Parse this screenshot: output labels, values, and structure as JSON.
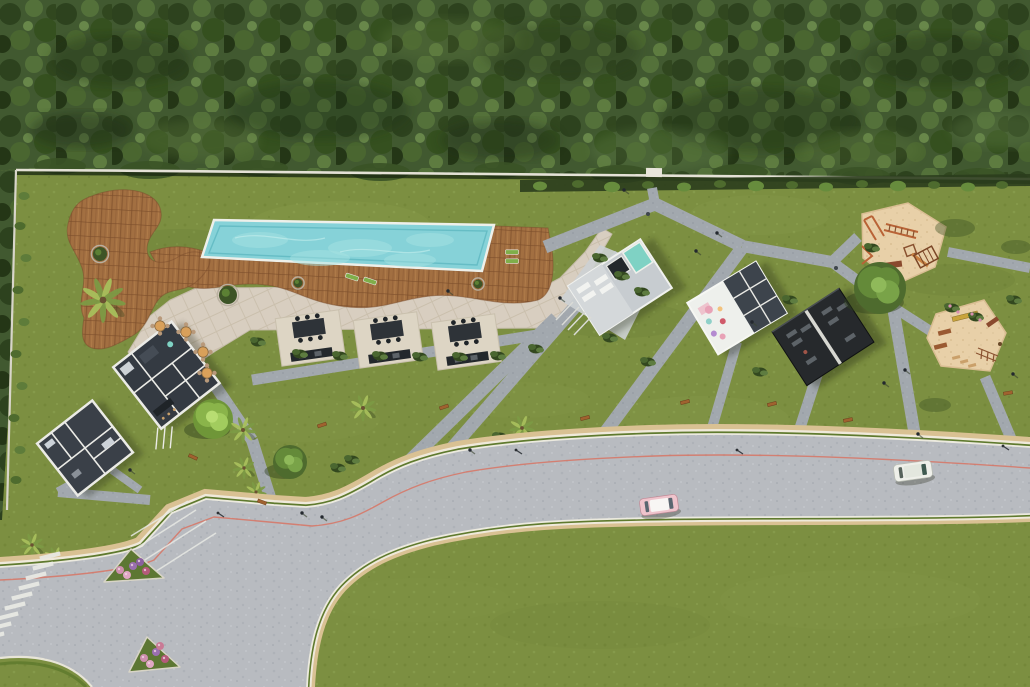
{
  "palette": {
    "lawn": "#7c8f41",
    "forest": "#415930",
    "wood": "#a26f41",
    "pool_water": "#86d2d8",
    "terrace": "#d8cec0",
    "path_gray": "#a2a8ae",
    "road": "#b8bbc0",
    "sand": "#e8d0a8",
    "hedge_dark": "#2b3d1d",
    "wall": "#e4e1d6",
    "red_line": "#d9705e",
    "curb_tan": "#d9c193",
    "verge_green": "#5f7a2e",
    "cream": "#efe9da",
    "flower_pink": "#cf8fae",
    "flower_purple": "#9a6fb0",
    "car_pink": "#efc4cc",
    "car_white": "#eff0ea",
    "equipment_orange": "#b96336",
    "building_floor": "#343a42",
    "building_wall": "#ebebe6",
    "black_pavilion": "#26292c",
    "teal_pool": "#7fd2c4",
    "lounger_green": "#7fae4a",
    "shadow": "#1a2410"
  },
  "scene": {
    "walk_paths": [
      [
        655,
        204,
        652,
        188,
        10
      ],
      [
        655,
        204,
        545,
        247,
        13
      ],
      [
        655,
        204,
        742,
        246,
        13
      ],
      [
        742,
        246,
        832,
        262,
        12
      ],
      [
        832,
        262,
        858,
        237,
        11
      ],
      [
        948,
        252,
        1030,
        268,
        10
      ],
      [
        832,
        262,
        893,
        307,
        11
      ],
      [
        893,
        307,
        932,
        332,
        10
      ],
      [
        893,
        307,
        915,
        436,
        12
      ],
      [
        985,
        377,
        1012,
        441,
        11
      ],
      [
        742,
        248,
        604,
        434,
        13
      ],
      [
        620,
        255,
        452,
        448,
        13
      ],
      [
        556,
        318,
        400,
        470,
        13
      ],
      [
        252,
        380,
        556,
        332,
        11
      ],
      [
        210,
        378,
        252,
        440,
        12
      ],
      [
        252,
        440,
        274,
        510,
        12
      ],
      [
        150,
        500,
        58,
        492,
        10
      ],
      [
        58,
        492,
        98,
        470,
        9
      ],
      [
        818,
        372,
        800,
        428,
        11
      ],
      [
        737,
        342,
        712,
        428,
        10
      ],
      [
        112,
        470,
        140,
        490,
        8
      ]
    ],
    "bbq_pads": [
      [
        310,
        336
      ],
      [
        388,
        338
      ],
      [
        466,
        340
      ]
    ],
    "benches": [
      [
        322,
        425,
        -18
      ],
      [
        444,
        407,
        -18
      ],
      [
        193,
        457,
        25
      ],
      [
        262,
        502,
        20
      ],
      [
        585,
        418,
        -14
      ],
      [
        685,
        402,
        -14
      ],
      [
        772,
        404,
        -14
      ],
      [
        848,
        420,
        -12
      ],
      [
        1008,
        393,
        -10
      ]
    ],
    "people": [
      [
        624,
        190
      ],
      [
        717,
        233
      ],
      [
        752,
        322
      ],
      [
        884,
        383
      ],
      [
        918,
        434
      ],
      [
        302,
        513
      ],
      [
        322,
        517
      ],
      [
        470,
        450
      ],
      [
        1013,
        374
      ],
      [
        696,
        251
      ],
      [
        905,
        370
      ],
      [
        130,
        470
      ],
      [
        448,
        291
      ],
      [
        560,
        298
      ]
    ],
    "street_lamps": [
      [
        218,
        513
      ],
      [
        516,
        450
      ],
      [
        737,
        450
      ],
      [
        1003,
        446
      ]
    ],
    "bins": [
      [
        648,
        214
      ],
      [
        836,
        268
      ]
    ],
    "palms": [
      [
        103,
        300,
        1.7
      ],
      [
        243,
        430,
        1.0
      ],
      [
        363,
        408,
        1.0
      ],
      [
        522,
        428,
        0.95
      ],
      [
        244,
        468,
        0.85
      ],
      [
        256,
        492,
        0.8
      ],
      [
        32,
        545,
        0.9
      ],
      [
        55,
        558,
        0.85
      ]
    ],
    "loungers": [
      [
        512,
        252,
        0
      ],
      [
        512,
        261,
        0
      ],
      [
        352,
        277,
        18
      ],
      [
        370,
        281,
        18
      ]
    ],
    "dining_tables": [
      [
        160,
        326
      ],
      [
        186,
        332
      ],
      [
        203,
        352
      ],
      [
        207,
        373
      ]
    ],
    "planters": [
      [
        298,
        283,
        4.5
      ],
      [
        478,
        284,
        4.5
      ],
      [
        228,
        295,
        9
      ],
      [
        100,
        254,
        7
      ]
    ],
    "trees": [
      [
        880,
        288,
        26,
        "std"
      ],
      [
        213,
        419,
        20,
        "light"
      ],
      [
        290,
        462,
        17,
        "std"
      ]
    ],
    "tree_shadows": [
      [
        955,
        228,
        20,
        9
      ],
      [
        1016,
        247,
        15,
        7
      ],
      [
        935,
        405,
        16,
        7
      ]
    ],
    "shrub_clusters": [
      [
        352,
        460
      ],
      [
        338,
        468
      ],
      [
        500,
        437
      ],
      [
        610,
        338
      ],
      [
        648,
        362
      ],
      [
        700,
        432
      ],
      [
        760,
        372
      ],
      [
        952,
        308
      ],
      [
        976,
        317
      ],
      [
        872,
        248
      ],
      [
        600,
        258
      ],
      [
        622,
        276
      ],
      [
        642,
        292
      ],
      [
        258,
        342
      ],
      [
        1014,
        300
      ],
      [
        536,
        349
      ],
      [
        790,
        300
      ],
      [
        300,
        354
      ],
      [
        340,
        356
      ],
      [
        380,
        356
      ],
      [
        420,
        357
      ],
      [
        460,
        357
      ],
      [
        498,
        356
      ]
    ],
    "flower_dots": [
      [
        950,
        306
      ],
      [
        958,
        312
      ],
      [
        972,
        314
      ],
      [
        980,
        320
      ]
    ],
    "wall_shrubs": [
      [
        540,
        186,
        7
      ],
      [
        578,
        184,
        6
      ],
      [
        612,
        187,
        8
      ],
      [
        648,
        185,
        6
      ],
      [
        684,
        187,
        7
      ],
      [
        720,
        184,
        6
      ],
      [
        756,
        186,
        8
      ],
      [
        792,
        185,
        6
      ],
      [
        826,
        187,
        7
      ],
      [
        862,
        184,
        6
      ],
      [
        898,
        186,
        8
      ],
      [
        934,
        185,
        6
      ],
      [
        968,
        187,
        7
      ],
      [
        1002,
        185,
        6
      ]
    ],
    "vines_left": [
      [
        24,
        196
      ],
      [
        20,
        226
      ],
      [
        26,
        258
      ],
      [
        18,
        290
      ],
      [
        24,
        322
      ],
      [
        16,
        354
      ],
      [
        22,
        386
      ],
      [
        14,
        418
      ],
      [
        20,
        450
      ],
      [
        16,
        480
      ]
    ],
    "forest_patches": [
      [
        120,
        60,
        70,
        26,
        "#243618",
        0.4
      ],
      [
        320,
        110,
        90,
        30,
        "#1f3014",
        0.35
      ],
      [
        560,
        50,
        80,
        28,
        "#2a3d1c",
        0.4
      ],
      [
        760,
        120,
        100,
        32,
        "#223417",
        0.38
      ],
      [
        940,
        60,
        80,
        26,
        "#243618",
        0.4
      ],
      [
        200,
        140,
        60,
        20,
        "#5e7a3c",
        0.3
      ],
      [
        450,
        40,
        70,
        22,
        "#5e7a3c",
        0.28
      ],
      [
        660,
        150,
        70,
        22,
        "#64824a",
        0.3
      ],
      [
        860,
        150,
        60,
        20,
        "#5e7a3c",
        0.28
      ],
      [
        1000,
        130,
        50,
        18,
        "#64824a",
        0.3
      ],
      [
        80,
        130,
        50,
        18,
        "#1c2b12",
        0.4
      ],
      [
        500,
        140,
        60,
        20,
        "#1c2b12",
        0.35
      ]
    ],
    "forest_fringe": [
      [
        60,
        166,
        26,
        8
      ],
      [
        150,
        170,
        30,
        9
      ],
      [
        260,
        168,
        28,
        8
      ],
      [
        380,
        172,
        30,
        9
      ],
      [
        500,
        170,
        26,
        8
      ],
      [
        620,
        174,
        30,
        9
      ],
      [
        740,
        172,
        28,
        8
      ],
      [
        860,
        176,
        30,
        9
      ],
      [
        980,
        176,
        26,
        8
      ]
    ],
    "lawn_patches": [
      [
        340,
        225,
        90,
        24,
        "#93a654",
        0.18
      ],
      [
        760,
        215,
        70,
        20,
        "#93a654",
        0.15
      ],
      [
        300,
        420,
        80,
        22,
        "#8ba04e",
        0.15
      ],
      [
        700,
        420,
        90,
        24,
        "#93a654",
        0.15
      ],
      [
        870,
        460,
        80,
        20,
        "#8ba04e",
        0.12
      ],
      [
        520,
        400,
        70,
        18,
        "#93a654",
        0.12
      ],
      [
        180,
        245,
        60,
        16,
        "#5f7330",
        0.18
      ],
      [
        620,
        320,
        70,
        18,
        "#5f7330",
        0.15
      ],
      [
        430,
        300,
        60,
        16,
        "#5f7330",
        0.12
      ],
      [
        955,
        280,
        60,
        16,
        "#5f7330",
        0.15
      ],
      [
        850,
        600,
        130,
        30,
        "#93a654",
        0.12
      ],
      [
        600,
        625,
        110,
        24,
        "#5f7330",
        0.1
      ],
      [
        420,
        600,
        90,
        22,
        "#8ba04e",
        0.1
      ]
    ],
    "crosswalk_stripes": [
      [
        50,
        556
      ],
      [
        43,
        566
      ],
      [
        36,
        576
      ],
      [
        29,
        586
      ],
      [
        22,
        596
      ],
      [
        15,
        606
      ],
      [
        8,
        616
      ],
      [
        1,
        626
      ],
      [
        -6,
        636
      ]
    ],
    "parking_lines": [
      [
        147,
        577,
        216,
        533
      ],
      [
        140,
        563,
        206,
        521
      ],
      [
        135,
        549,
        196,
        510
      ],
      [
        131,
        536,
        188,
        501
      ]
    ],
    "flower_beds": [
      {
        "points": "104,582 131,549 164,578",
        "flowers": [
          [
            120,
            570,
            "#cf8fae"
          ],
          [
            133,
            566,
            "#9a6fb0"
          ],
          [
            146,
            571,
            "#b55a7a"
          ],
          [
            127,
            575,
            "#e0a7c4"
          ],
          [
            140,
            562,
            "#8a5fa0"
          ]
        ]
      },
      {
        "points": "129,672 147,637 180,667",
        "flowers": [
          [
            144,
            658,
            "#cf8fae"
          ],
          [
            156,
            652,
            "#9a6fb0"
          ],
          [
            165,
            659,
            "#b55a7a"
          ],
          [
            150,
            664,
            "#e0a7c4"
          ],
          [
            160,
            646,
            "#c97a95"
          ]
        ]
      }
    ],
    "pool_sparkles": [
      [
        260,
        240,
        28,
        8
      ],
      [
        360,
        248,
        32,
        9
      ],
      [
        430,
        240,
        24,
        7
      ],
      [
        320,
        258,
        30,
        8
      ],
      [
        410,
        260,
        26,
        7
      ]
    ],
    "kids_dots": [
      [
        712,
        295,
        "#e8a2b6",
        4
      ],
      [
        706,
        305,
        "#8fd0c8",
        3
      ],
      [
        718,
        312,
        "#d05a6a",
        3
      ],
      [
        704,
        318,
        "#b48ad0",
        3
      ],
      [
        722,
        300,
        "#f3c27c",
        2.5
      ],
      [
        710,
        325,
        "#e8a2b6",
        3
      ]
    ],
    "gym_equipment": [
      [
        793,
        315
      ],
      [
        793,
        325
      ],
      [
        808,
        318
      ],
      [
        835,
        315
      ],
      [
        835,
        327
      ],
      [
        850,
        320
      ],
      [
        840,
        350
      ],
      [
        795,
        348
      ]
    ]
  }
}
